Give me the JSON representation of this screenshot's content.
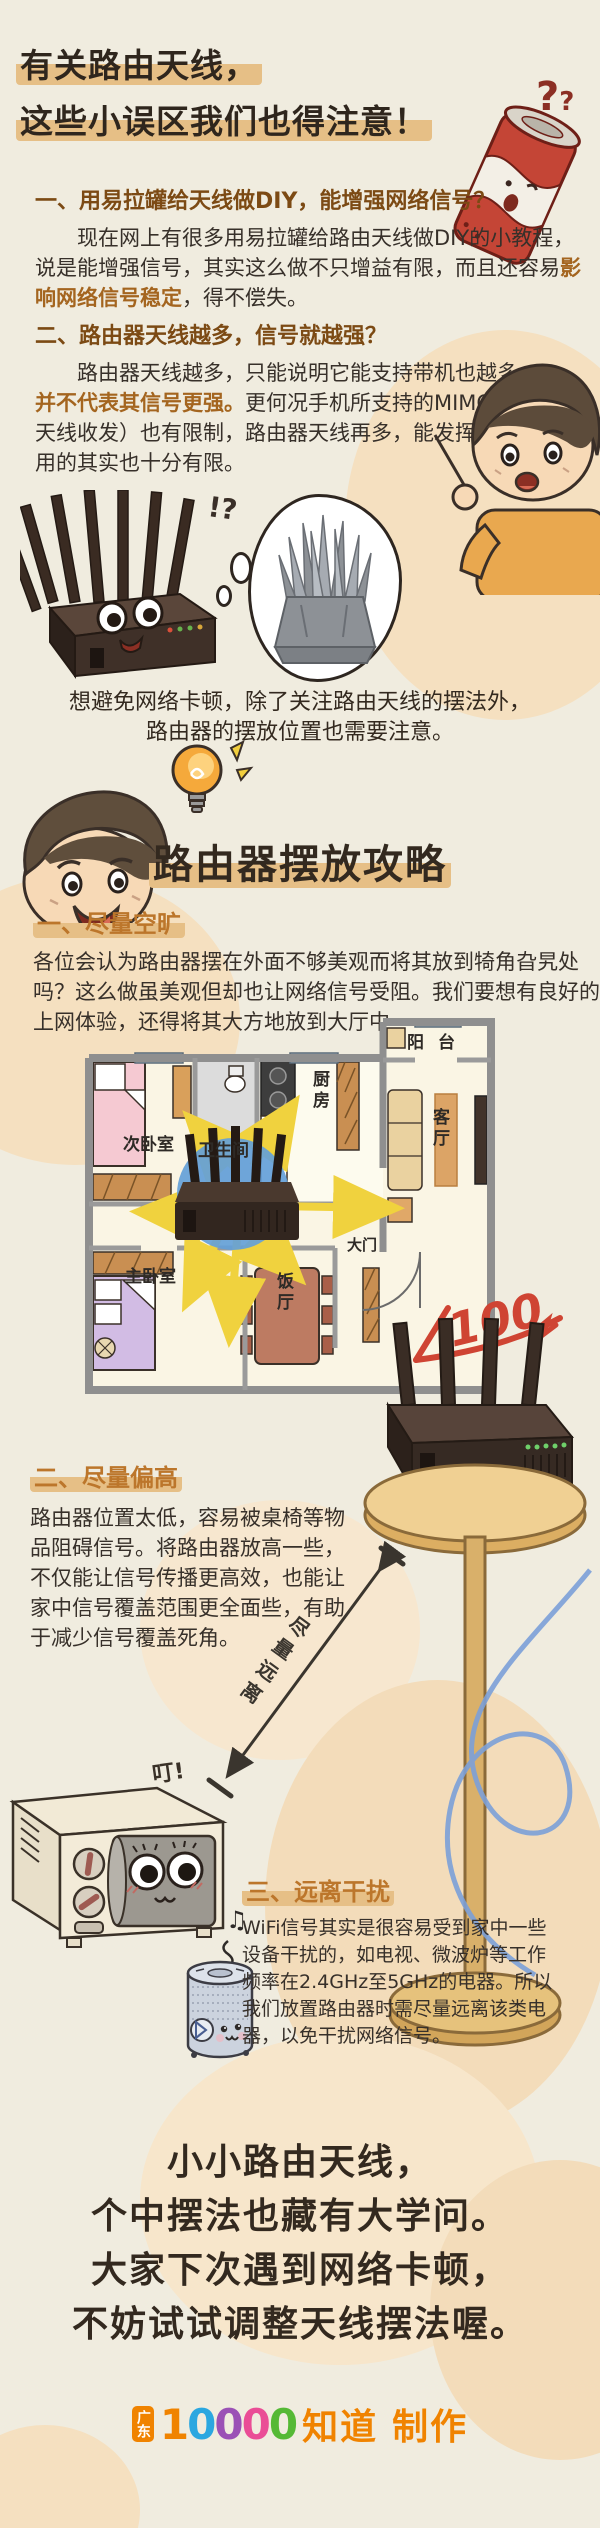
{
  "colors": {
    "background": "#f0ecdf",
    "blob_tan": "#f4dfc0",
    "highlight_tan": "#e6bf86",
    "heading_brown": "#7c4a14",
    "emphasis_brown": "#a4651f",
    "tip_heading_orange": "#bc762b",
    "body_text": "#37302a",
    "arrow_yellow": "#f0d23e",
    "signal_blue": "#64a0d8",
    "score_red": "#cf4433",
    "swirl_blue": "#7ba0d8",
    "logo_orange": "#f08300",
    "digit_colors": [
      "#f08300",
      "#2ba7e0",
      "#9b51b6",
      "#ea4d96",
      "#55b935"
    ]
  },
  "header": {
    "title_line1": "有关路由天线，",
    "title_line2": "这些小误区我们也得注意！",
    "question_marks_big": "?",
    "question_marks_small": "?"
  },
  "misconceptions": {
    "item1": {
      "heading": "一、用易拉罐给天线做DIY，能增强网络信号？",
      "body_start": "现在网上有很多用易拉罐给路由天线做DIY的小教程，说是能增强信号，其实这么做不只增益有限，而且还容易",
      "emphasis": "影响网络信号稳定",
      "body_end": "，得不偿失。"
    },
    "item2": {
      "heading": "二、路由器天线越多，信号就越强？",
      "body_start": "路由器天线越多，只能说明它能支持带机也越多，",
      "emphasis": "并不代表其信号更强。",
      "body_end": "更何况手机所支持的MIMO（多天线收发）也有限制，路由器天线再多，能发挥通信作用的其实也十分有限。"
    }
  },
  "router_exclaim": "!?",
  "transition": {
    "line1": "想避免网络卡顿，除了关注路由天线的摆法外，",
    "line2": "路由器的摆放位置也需要注意。"
  },
  "guide": {
    "title": "路由器摆放攻略"
  },
  "tips": {
    "tip1": {
      "heading": "一、尽量空旷",
      "body": "各位会认为路由器摆在外面不够美观而将其放到犄角旮旯处吗？这么做虽美观但却也让网络信号受阻。我们要想有良好的上网体验，还得将其大方地放到大厅中。"
    },
    "tip2": {
      "heading": "二、尽量偏高",
      "body": "路由器位置太低，容易被桌椅等物品阻碍信号。将路由器放高一些，不仅能让信号传播更高效，也能让家中信号覆盖范围更全面些，有助于减少信号覆盖死角。"
    },
    "tip3": {
      "heading": "三、远离干扰",
      "body": "WiFi信号其实是很容易受到家中一些设备干扰的，如电视、微波炉等工作频率在2.4GHz至5GHz的电器。所以我们放置路由器时需尽量远离该类电器，以免干扰网络信号。"
    }
  },
  "floorplan": {
    "balcony": "阳台",
    "living_room": "客厅",
    "kitchen": "厨房",
    "bathroom": "卫生间",
    "second_bedroom": "次卧室",
    "master_bedroom": "主卧室",
    "dining_room": "饭厅",
    "main_door": "大门",
    "score_mark": "100"
  },
  "annotations": {
    "distance_label": "尽量远离",
    "microwave_sound": "叮!",
    "music_note": "♫"
  },
  "ending": {
    "line1": "小小路由天线，",
    "line2": "个中摆法也藏有大学问。",
    "line3": "大家下次遇到网络卡顿，",
    "line4": "不妨试试调整天线摆法喔。"
  },
  "footer": {
    "region": "广东",
    "digit1": "1",
    "digit2": "0",
    "digit3": "0",
    "digit4": "0",
    "digit5": "0",
    "brand": "知道",
    "suffix": "制作"
  }
}
